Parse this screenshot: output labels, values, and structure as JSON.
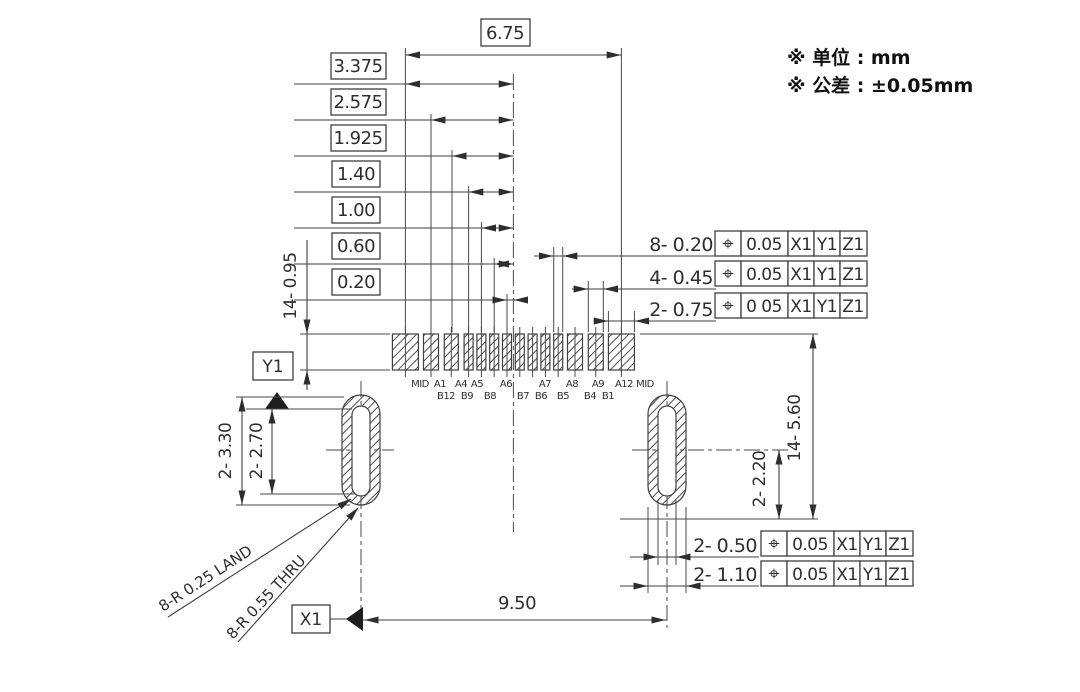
{
  "notes": {
    "unit": "※ 单位 : mm",
    "tolerance": "※ 公差 : ±0.05mm"
  },
  "top_dims": [
    "6.75",
    "3.375",
    "2.575",
    "1.925",
    "1.40",
    "1.00",
    "0.60",
    "0.20"
  ],
  "left_dims": {
    "pad_length": "14- 0.95",
    "oval_outer": "2- 3.30",
    "oval_inner": "2- 2.70"
  },
  "right_dims": {
    "row_depth": "14- 5.60",
    "oval_offset": "2- 2.20"
  },
  "bottom_dim": "9.50",
  "datums": {
    "x": "X1",
    "y": "Y1"
  },
  "radius_leaders": {
    "land": "8-R 0.25 LAND",
    "thru": "8-R 0.55 THRU"
  },
  "fcf_rows": [
    {
      "label": "8- 0.20",
      "symbol": "⌖",
      "tolerance": "0.05",
      "ref1": "X1",
      "ref2": "Y1",
      "ref3": "Z1"
    },
    {
      "label": "4- 0.45",
      "symbol": "⌖",
      "tolerance": "0.05",
      "ref1": "X1",
      "ref2": "Y1",
      "ref3": "Z1"
    },
    {
      "label": "2- 0.75",
      "symbol": "⌖",
      "tolerance": "0 05",
      "ref1": "X1",
      "ref2": "Y1",
      "ref3": "Z1"
    },
    {
      "label": "2- 0.50",
      "symbol": "⌖",
      "tolerance": "0.05",
      "ref1": "X1",
      "ref2": "Y1",
      "ref3": "Z1"
    },
    {
      "label": "2- 1.10",
      "symbol": "⌖",
      "tolerance": "0.05",
      "ref1": "X1",
      "ref2": "Y1",
      "ref3": "Z1"
    }
  ],
  "pins_top": [
    "MID",
    "A1",
    "A4",
    "A5",
    "A6",
    "A7",
    "A8",
    "A9",
    "A12",
    "MID"
  ],
  "pins_bottom": [
    "B12",
    "B9",
    "B8",
    "B7",
    "B6",
    "B5",
    "B4",
    "B1"
  ],
  "colors": {
    "line": "#3f3f3f",
    "text": "#2e2e2e",
    "background": "#ffffff"
  }
}
